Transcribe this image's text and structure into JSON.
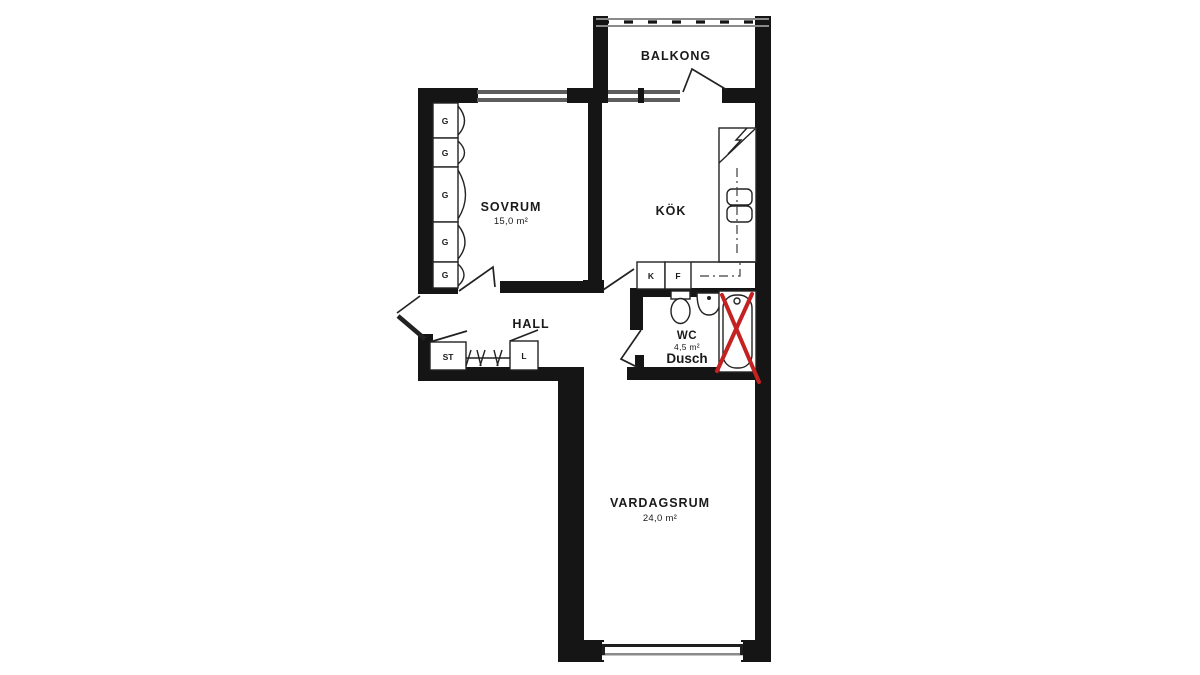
{
  "plan": {
    "balcony": {
      "label": "BALKONG"
    },
    "bedroom": {
      "label": "SOVRUM",
      "area": "15,0 m²"
    },
    "kitchen": {
      "label": "KÖK"
    },
    "hall": {
      "label": "HALL"
    },
    "wc": {
      "label": "WC",
      "area": "4,5 m²",
      "shower": "Dusch"
    },
    "living_room": {
      "label": "VARDAGSRUM",
      "area": "24,0 m²"
    },
    "fixtures": {
      "wardrobe": "G",
      "cleaning_closet": "ST",
      "linen_closet": "L",
      "fridge": "K",
      "freezer": "F"
    },
    "colors": {
      "wall": "#151515",
      "line": "#222222",
      "window": "#5c5c5c",
      "railing": "#8a8a8a",
      "annotation": "#c42121"
    }
  }
}
